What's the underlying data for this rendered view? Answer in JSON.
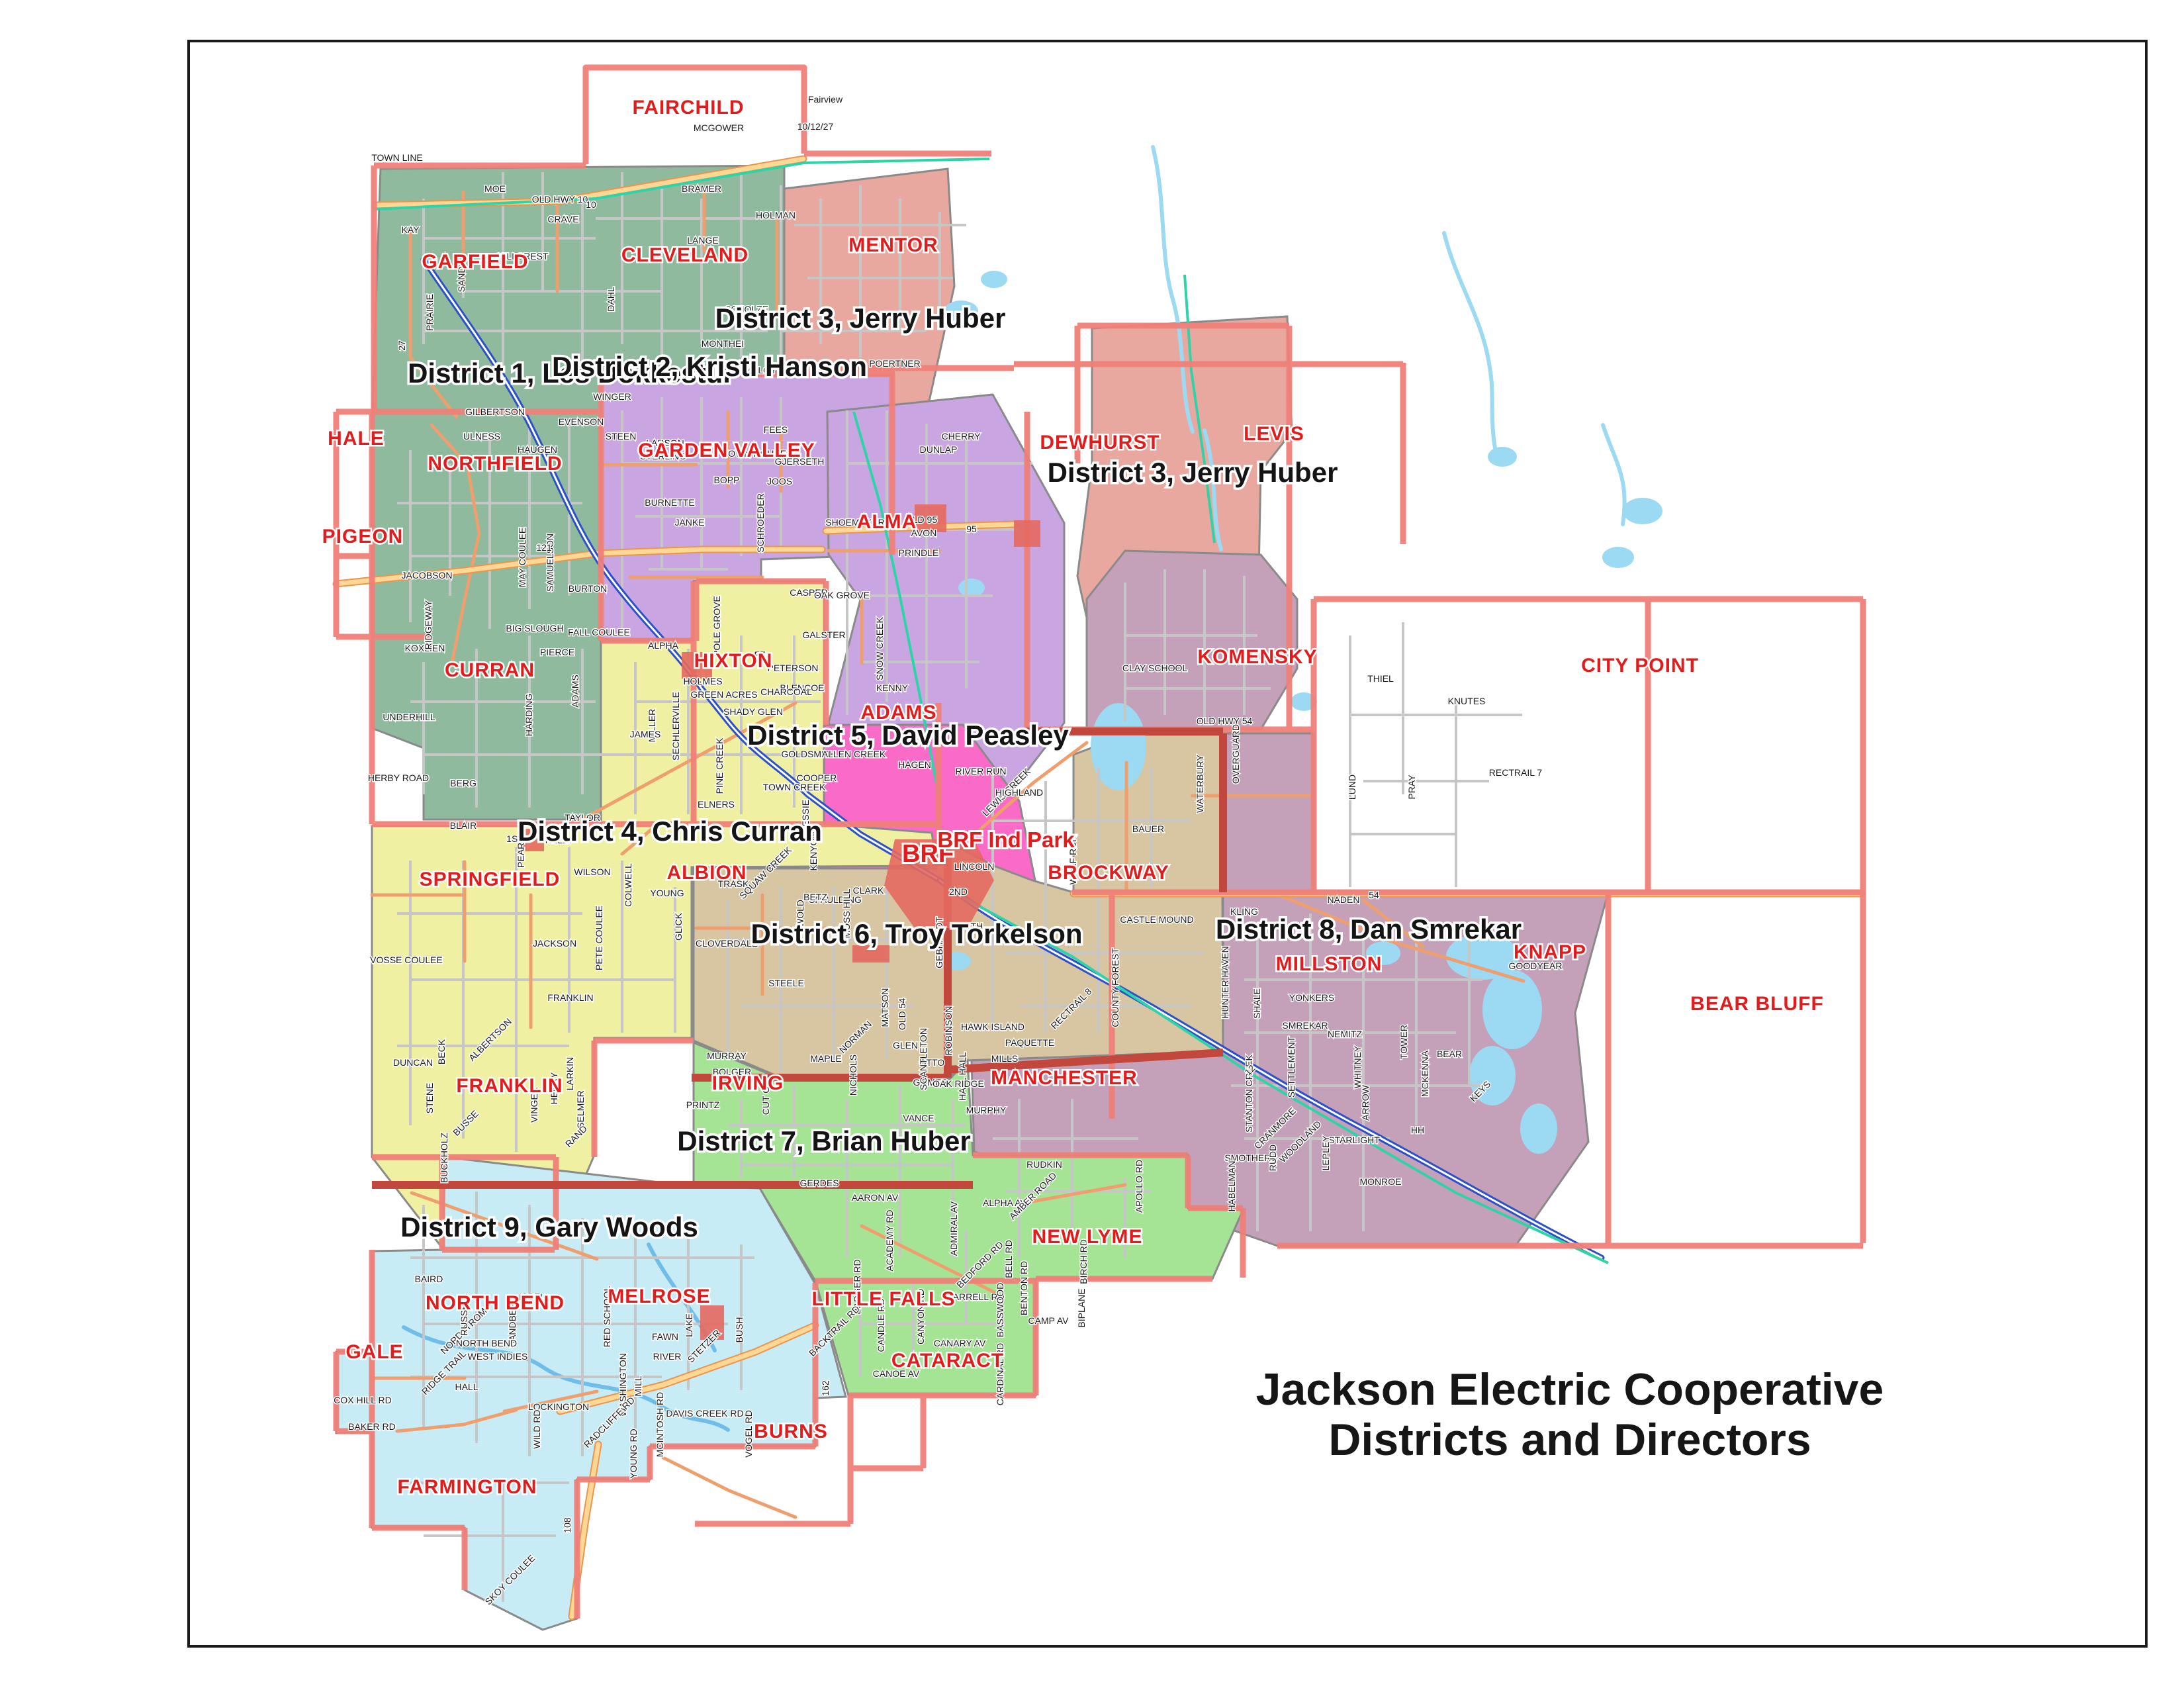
{
  "title": {
    "line1": "Jackson Electric Cooperative",
    "line2": "Districts and Directors"
  },
  "districts": [
    {
      "name": "District 1",
      "director": "Les Dokkestul",
      "label": "District 1,  Les Dokkestul",
      "color": "#8fba9d"
    },
    {
      "name": "District 2",
      "director": "Kristi Hanson",
      "label": "District 2,  Kristi Hanson",
      "color": "#c9a6e1"
    },
    {
      "name": "District 3",
      "director": "Jerry Huber",
      "label": "District 3,  Jerry Huber",
      "color": "#e9a89f"
    },
    {
      "name": "District 4",
      "director": "Chris Curran",
      "label": "District 4,  Chris Curran",
      "color": "#f0f0a3"
    },
    {
      "name": "District 5",
      "director": "David Peasley",
      "label": "District 5,  David Peasley",
      "color": "#fa6bc8"
    },
    {
      "name": "District 6",
      "director": "Troy Torkelson",
      "label": "District 6,  Troy Torkelson",
      "color": "#d8c5a2"
    },
    {
      "name": "District 7",
      "director": "Brian Huber",
      "label": "District 7,  Brian Huber",
      "color": "#a5e494"
    },
    {
      "name": "District 8",
      "director": "Dan Smrekar",
      "label": "District 8,  Dan Smrekar",
      "color": "#c5a1b9"
    },
    {
      "name": "District 9",
      "director": "Gary Woods",
      "label": "District 9,  Gary Woods",
      "color": "#c8ecf6"
    }
  ],
  "colors": {
    "alma_purple": "#c9a6e1",
    "boundary_red": "#ef8078",
    "district_boundary_dark": "#c2473d",
    "township_label_red": "#e11c1c",
    "road_orange": "#ef9e6e",
    "highway_yellow": "#ffd794",
    "highway_casing": "#e8964f",
    "river_blue": "#2b50c8",
    "water_blue": "#9cd9f2",
    "trail_teal": "#2fd3a8",
    "road_gray": "#c6c6c6",
    "urban_red": "#e4695f"
  },
  "townships": [
    "FAIRCHILD",
    "GARFIELD",
    "CLEVELAND",
    "MENTOR",
    "HALE",
    "NORTHFIELD",
    "GARDEN VALLEY",
    "DEWHURST",
    "LEVIS",
    "PIGEON",
    "ALMA",
    "CURRAN",
    "HIXTON",
    "KOMENSKY",
    "CITY POINT",
    "ADAMS",
    "SPRINGFIELD",
    "ALBION",
    "BROCKWAY",
    "MILLSTON",
    "KNAPP",
    "BEAR BLUFF",
    "FRANKLIN",
    "IRVING",
    "MANCHESTER",
    "NEW LYME",
    "NORTH BEND",
    "MELROSE",
    "LITTLE FALLS",
    "GALE",
    "CATARACT",
    "BURNS",
    "FARMINGTON"
  ],
  "places": {
    "brf": "BRF",
    "brf_ind_park": "BRF Ind Park"
  },
  "roads": [
    "TOWN LINE",
    "OLD HWY 10",
    "MCGOWER",
    "10/12/27",
    "BRAMER",
    "HOLMAN",
    "LANGE",
    "HILLCREST",
    "CRAVE",
    "KAY",
    "MOE",
    "PRAIRIE",
    "DAHL",
    "SCHOLZE",
    "MONTHEI",
    "GILOY",
    "OLSON",
    "POERTNER",
    "WINGER",
    "EVENSON",
    "STEEN",
    "GILBERTSON",
    "ULNESS",
    "HAUGEN",
    "LARSON",
    "TOWN HOUSE",
    "FEES",
    "STERLING",
    "GJERSETH",
    "BOPP",
    "JOOS",
    "BURNETTE",
    "JANKE",
    "SCHROEDER",
    "DUNLAP",
    "CHERRY",
    "SHOEMAKER",
    "OLD 95",
    "AVON",
    "PRINDLE",
    "CASPER",
    "OAK GROVE",
    "BLENCOE",
    "KENNY",
    "SNOW CREEK",
    "GALSTER",
    "JACOBSON",
    "MAY COULEE",
    "SAMUELSON",
    "BURTON",
    "BIG SLOUGH",
    "FALL COULEE",
    "KOXLIEN",
    "UNDERHILL",
    "HERBY ROAD",
    "RIDGEWAY",
    "HARDING",
    "ADAMS",
    "BERG",
    "PIERCE",
    "ALPHA",
    "HOLMES",
    "GREEN ACRES",
    "CHARCOAL",
    "SHADY GLEN",
    "FF",
    "PETERSON",
    "POLE GROVE",
    "PINE CREEK",
    "MILLER",
    "JAMES",
    "SECHLERVILLE",
    "TAYLOR",
    "KELLY",
    "ELNERS",
    "TOWN CREEK",
    "BLAIR",
    "WILSON",
    "SPAULDING",
    "KENYON",
    "JESSIE",
    "CLARK",
    "HAGEN",
    "GOLDSMITH",
    "ALLEN CREEK",
    "COOPER",
    "RIVER RUN",
    "LEWIS CREEK",
    "HIGHLAND",
    "BAUER",
    "CASTLE MOUND",
    "KLING",
    "WOLF RUN",
    "HUNTER HAVEN",
    "COUNTY FOREST",
    "RECTRAIL 8",
    "LINCOLN",
    "2ND",
    "7TH",
    "GEBHARDT",
    "CLAY SCHOOL",
    "OLD HWY 54",
    "WATERBURY",
    "OVERGUARD",
    "LUND",
    "PRAY",
    "THIEL",
    "KNUTES",
    "RECTRAIL 7",
    "SMREKAR",
    "YONKERS",
    "NEMITZ",
    "WHITNEY",
    "TOWER",
    "MCKENNA",
    "BEAR",
    "KEYS",
    "SHALE",
    "STANTON CREEK",
    "SETTLEMENT",
    "CRANMORE",
    "WOODLAND",
    "SMOTHERS",
    "HABELMAN",
    "GOODYEAR",
    "NADEN",
    "STARLIGHT",
    "LEPLEY",
    "RUDD",
    "MONROE",
    "ARROW",
    "HH",
    "MURRAY",
    "BOLGER",
    "PRINTZ",
    "MAPLE",
    "NICHOLS",
    "NORMAN",
    "GLEN",
    "OTTO",
    "GOMER",
    "MILLS",
    "HALL HALL",
    "PAQUETTE",
    "MURPHY",
    "VANCE",
    "GERDES",
    "RUDKIN",
    "AARON AV",
    "ALPHA AV",
    "ADMIRAL AV",
    "ACADEMY RD",
    "SELMER",
    "LARKIN",
    "HENRY",
    "VINGER",
    "RAND",
    "CUT OFF",
    "ALBERTSON",
    "BECK",
    "DUNCAN",
    "STENE",
    "BUSSE",
    "BUCKHOLZ",
    "WEST INDIES",
    "WASHINGTON",
    "MILL",
    "FAWN",
    "RIVER",
    "NORDSTROM",
    "RIDGE TRAIL",
    "BAIRD",
    "RUSSELL",
    "SANDBERG",
    "ISBELL",
    "NORTH BEND",
    "HALL",
    "RED SCHOOL",
    "LAKE",
    "STETZER",
    "BUSH",
    "MCINTOSH RD",
    "DAVIS CREEK RD",
    "VOGEL RD",
    "LOCKINGTON",
    "RADCLIFFE RD",
    "WILD RD",
    "YOUNG RD",
    "COX HILL RD",
    "BAKER RD",
    "SKOY COULEE",
    "BADGER RD",
    "BACKTRAIL RD",
    "CANDLE RD",
    "CANYON RD",
    "CANOE AV",
    "CANARY AV",
    "BARRELL RD",
    "BASSWOOD",
    "CARDINAL RD",
    "AMBER ROAD",
    "APOLLO RD",
    "BELL RD",
    "BENTON RD",
    "BIRCH RD",
    "BIPLANE",
    "CAMP AV",
    "BEDFORD RD",
    "VOSSE COULEE",
    "HAWK ISLAND",
    "OAK RIDGE",
    "MATSON",
    "OLD 54",
    "ROBINSON",
    "SCANTLETON",
    "STEELE",
    "CLOVERDALE",
    "GLICK",
    "TRASK",
    "SQUAW CREEK",
    "BETZ",
    "WOLD",
    "MOSS HILL",
    "YOUNG",
    "COLWELL",
    "FRANKLIN",
    "PETE COULEE",
    "JACKSON",
    "PEARL",
    "1ST",
    "SAND",
    "10",
    "121",
    "95",
    "54",
    "12",
    "108",
    "162",
    "27",
    "Fairview"
  ]
}
